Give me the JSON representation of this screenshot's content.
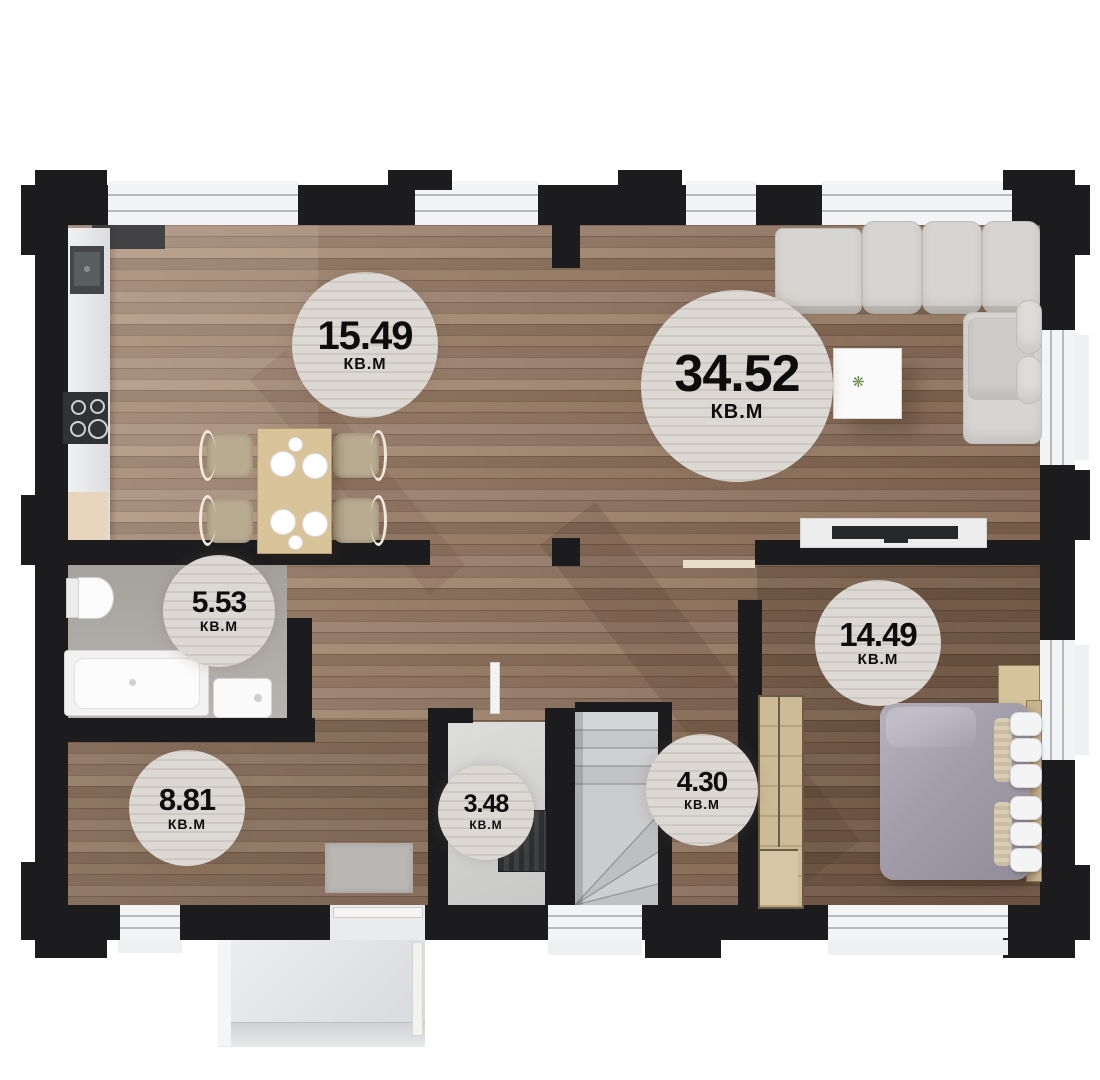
{
  "plan": {
    "title": "floor-plan-first-level",
    "unit": "КВ.М"
  },
  "rooms": [
    {
      "name": "kitchen-dining",
      "area": "15.49",
      "unit": "КВ.М"
    },
    {
      "name": "living-room",
      "area": "34.52",
      "unit": "КВ.М"
    },
    {
      "name": "bathroom",
      "area": "5.53",
      "unit": "КВ.М"
    },
    {
      "name": "bedroom",
      "area": "14.49",
      "unit": "КВ.М"
    },
    {
      "name": "entry-hall",
      "area": "8.81",
      "unit": "КВ.М"
    },
    {
      "name": "boiler-room",
      "area": "3.48",
      "unit": "КВ.М"
    },
    {
      "name": "stair-hall",
      "area": "4.30",
      "unit": "КВ.М"
    }
  ],
  "colors": {
    "wall": "#1c1c1e",
    "wood_base": "#8b6f5c",
    "bathroom_floor": "#aba8a4",
    "boiler_floor": "#d4d5d3",
    "stairs": "#c8c9cb",
    "porch": "#e2e5e7",
    "badge_bg": "#dcd9d5",
    "badge_text": "#0d0d0d",
    "sofa": "#d7d5d1",
    "bed_blanket": "#a19daa",
    "furniture_tan": "#d9c49a"
  }
}
